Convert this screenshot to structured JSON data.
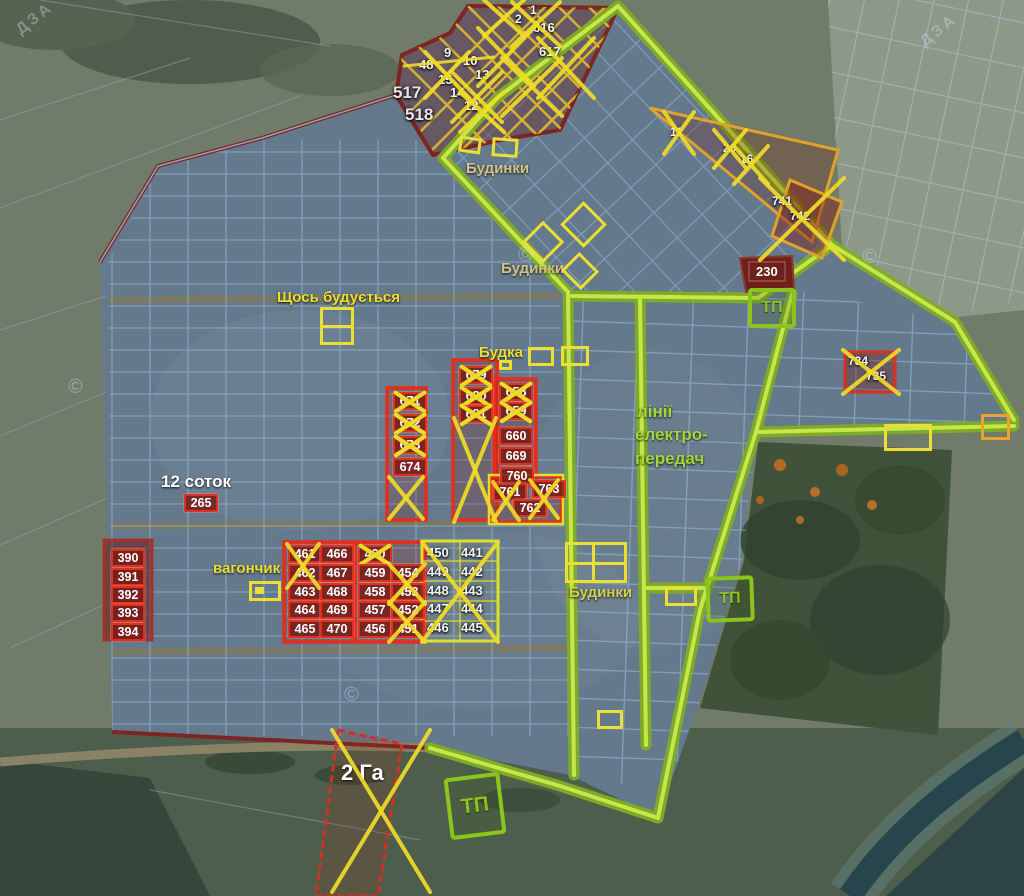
{
  "map": {
    "colors": {
      "lime_road": "#a8d838",
      "yellow_mark": "#f0dc28",
      "red_plot": "#e0301e",
      "maroon_boundary": "#7c2624",
      "blue_grid": "#9cc4e4",
      "tan_label": "#d2c387"
    },
    "labels": [
      {
        "t": "Будинки",
        "x": 466,
        "y": 160,
        "c": "tan"
      },
      {
        "t": "Будинки",
        "x": 501,
        "y": 260,
        "c": "tan"
      },
      {
        "t": "Щось будується",
        "x": 277,
        "y": 289,
        "c": "yellow"
      },
      {
        "t": "Будка",
        "x": 479,
        "y": 344,
        "c": "yellow"
      },
      {
        "t": "лінії",
        "x": 637,
        "y": 402,
        "c": "lime",
        "s": 17
      },
      {
        "t": "електро-",
        "x": 635,
        "y": 425,
        "c": "lime",
        "s": 17
      },
      {
        "t": "передач",
        "x": 635,
        "y": 449,
        "c": "lime",
        "s": 17
      },
      {
        "t": "12 соток",
        "x": 161,
        "y": 472,
        "c": "white",
        "s": 17
      },
      {
        "t": "вагончик",
        "x": 213,
        "y": 560,
        "c": "yellow"
      },
      {
        "t": "Будинки",
        "x": 569,
        "y": 584,
        "c": "khaki"
      },
      {
        "t": "2 Га",
        "x": 341,
        "y": 760,
        "c": "white",
        "s": 22
      }
    ],
    "plots": [
      {
        "n": "2",
        "x": 515,
        "y": 12,
        "s": "plain sm"
      },
      {
        "n": "1",
        "x": 530,
        "y": 3,
        "s": "plain sm"
      },
      {
        "n": "616",
        "x": 533,
        "y": 20,
        "s": "plain"
      },
      {
        "n": "617",
        "x": 539,
        "y": 44,
        "s": "plain"
      },
      {
        "n": "9",
        "x": 444,
        "y": 45,
        "s": "plain"
      },
      {
        "n": "48",
        "x": 419,
        "y": 57,
        "s": "plain"
      },
      {
        "n": "10",
        "x": 463,
        "y": 53,
        "s": "plain"
      },
      {
        "n": "15",
        "x": 438,
        "y": 72,
        "s": "plain"
      },
      {
        "n": "13",
        "x": 475,
        "y": 67,
        "s": "plain"
      },
      {
        "n": "14",
        "x": 450,
        "y": 85,
        "s": "plain"
      },
      {
        "n": "12",
        "x": 464,
        "y": 98,
        "s": "plain"
      },
      {
        "n": "517",
        "x": 393,
        "y": 83,
        "s": "plain big"
      },
      {
        "n": "518",
        "x": 405,
        "y": 105,
        "s": "plain big"
      },
      {
        "n": "11",
        "x": 670,
        "y": 125,
        "s": "plain sm"
      },
      {
        "n": "20",
        "x": 723,
        "y": 141,
        "s": "plain sm"
      },
      {
        "n": "16",
        "x": 740,
        "y": 152,
        "s": "plain sm"
      },
      {
        "n": "741",
        "x": 772,
        "y": 194,
        "s": "plain sm"
      },
      {
        "n": "742",
        "x": 790,
        "y": 209,
        "s": "plain sm"
      },
      {
        "n": "230",
        "x": 748,
        "y": 261,
        "s": "dark"
      },
      {
        "n": "734",
        "x": 848,
        "y": 354,
        "s": "plain sm"
      },
      {
        "n": "735",
        "x": 866,
        "y": 369,
        "s": "plain sm"
      },
      {
        "n": "671",
        "x": 393,
        "y": 392,
        "s": "chip",
        "c": 1
      },
      {
        "n": "672",
        "x": 393,
        "y": 414,
        "s": "chip",
        "c": 1
      },
      {
        "n": "673",
        "x": 393,
        "y": 436,
        "s": "chip",
        "c": 1
      },
      {
        "n": "674",
        "x": 393,
        "y": 458,
        "s": "chip"
      },
      {
        "n": "679",
        "x": 459,
        "y": 366,
        "s": "chip",
        "c": 1
      },
      {
        "n": "680",
        "x": 459,
        "y": 387,
        "s": "chip",
        "c": 1
      },
      {
        "n": "681",
        "x": 459,
        "y": 405,
        "s": "chip",
        "c": 1
      },
      {
        "n": "658",
        "x": 499,
        "y": 383,
        "s": "chip",
        "c": 1
      },
      {
        "n": "659",
        "x": 499,
        "y": 402,
        "s": "chip",
        "c": 1
      },
      {
        "n": "660",
        "x": 499,
        "y": 427,
        "s": "chip"
      },
      {
        "n": "669",
        "x": 499,
        "y": 447,
        "s": "chip"
      },
      {
        "n": "760",
        "x": 500,
        "y": 467,
        "s": "chip"
      },
      {
        "n": "761",
        "x": 493,
        "y": 483,
        "s": "chip"
      },
      {
        "n": "763",
        "x": 532,
        "y": 480,
        "s": "chip"
      },
      {
        "n": "762",
        "x": 513,
        "y": 499,
        "s": "chip"
      },
      {
        "n": "265",
        "x": 184,
        "y": 494,
        "s": "chip"
      },
      {
        "n": "390",
        "x": 111,
        "y": 549,
        "s": "chip"
      },
      {
        "n": "391",
        "x": 111,
        "y": 568,
        "s": "chip"
      },
      {
        "n": "392",
        "x": 111,
        "y": 586,
        "s": "chip"
      },
      {
        "n": "393",
        "x": 111,
        "y": 604,
        "s": "chip"
      },
      {
        "n": "394",
        "x": 111,
        "y": 623,
        "s": "chip"
      },
      {
        "n": "461",
        "x": 288,
        "y": 545,
        "s": "chip"
      },
      {
        "n": "462",
        "x": 288,
        "y": 564,
        "s": "chip"
      },
      {
        "n": "463",
        "x": 288,
        "y": 583,
        "s": "chip"
      },
      {
        "n": "464",
        "x": 288,
        "y": 601,
        "s": "chip"
      },
      {
        "n": "465",
        "x": 288,
        "y": 620,
        "s": "chip"
      },
      {
        "n": "466",
        "x": 320,
        "y": 545,
        "s": "chip"
      },
      {
        "n": "467",
        "x": 320,
        "y": 564,
        "s": "chip"
      },
      {
        "n": "468",
        "x": 320,
        "y": 583,
        "s": "chip"
      },
      {
        "n": "469",
        "x": 320,
        "y": 601,
        "s": "chip"
      },
      {
        "n": "470",
        "x": 320,
        "y": 620,
        "s": "chip"
      },
      {
        "n": "460",
        "x": 358,
        "y": 545,
        "s": "chip",
        "c": 1
      },
      {
        "n": "459",
        "x": 358,
        "y": 564,
        "s": "chip"
      },
      {
        "n": "458",
        "x": 358,
        "y": 583,
        "s": "chip"
      },
      {
        "n": "457",
        "x": 358,
        "y": 601,
        "s": "chip"
      },
      {
        "n": "456",
        "x": 358,
        "y": 620,
        "s": "chip"
      },
      {
        "n": "454",
        "x": 391,
        "y": 564,
        "s": "chip"
      },
      {
        "n": "453",
        "x": 391,
        "y": 583,
        "s": "chip"
      },
      {
        "n": "452",
        "x": 391,
        "y": 601,
        "s": "chip"
      },
      {
        "n": "451",
        "x": 391,
        "y": 620,
        "s": "chip"
      },
      {
        "n": "450",
        "x": 427,
        "y": 545,
        "s": "plain"
      },
      {
        "n": "449",
        "x": 427,
        "y": 564,
        "s": "plain"
      },
      {
        "n": "448",
        "x": 427,
        "y": 583,
        "s": "plain"
      },
      {
        "n": "447",
        "x": 427,
        "y": 601,
        "s": "plain"
      },
      {
        "n": "446",
        "x": 427,
        "y": 620,
        "s": "plain"
      },
      {
        "n": "441",
        "x": 461,
        "y": 545,
        "s": "plain"
      },
      {
        "n": "442",
        "x": 461,
        "y": 564,
        "s": "plain"
      },
      {
        "n": "443",
        "x": 461,
        "y": 583,
        "s": "plain"
      },
      {
        "n": "444",
        "x": 461,
        "y": 601,
        "s": "plain"
      },
      {
        "n": "445",
        "x": 461,
        "y": 620,
        "s": "plain"
      }
    ],
    "tp_boxes": [
      {
        "t": "ТП",
        "x": 748,
        "y": 288,
        "w": 40,
        "h": 32,
        "r": 0
      },
      {
        "t": "ТП",
        "x": 706,
        "y": 576,
        "w": 40,
        "h": 38,
        "r": -2
      },
      {
        "t": "ТП",
        "x": 447,
        "y": 775,
        "w": 48,
        "h": 54,
        "r": -7
      }
    ],
    "yellow_boxes": [
      {
        "x": 320,
        "y": 307,
        "w": 34,
        "h": 38,
        "mid": 1
      },
      {
        "x": 499,
        "y": 360,
        "w": 13,
        "h": 10
      },
      {
        "x": 528,
        "y": 347,
        "w": 26,
        "h": 19
      },
      {
        "x": 561,
        "y": 346,
        "w": 28,
        "h": 20
      },
      {
        "x": 459,
        "y": 137,
        "w": 22,
        "h": 16,
        "r": 8
      },
      {
        "x": 492,
        "y": 138,
        "w": 26,
        "h": 19,
        "r": 4
      },
      {
        "x": 528,
        "y": 227,
        "w": 30,
        "h": 30,
        "r": 45
      },
      {
        "x": 567,
        "y": 208,
        "w": 33,
        "h": 33,
        "r": 45
      },
      {
        "x": 566,
        "y": 258,
        "w": 28,
        "h": 26,
        "r": 45
      },
      {
        "x": 884,
        "y": 424,
        "w": 48,
        "h": 27
      },
      {
        "x": 981,
        "y": 414,
        "w": 29,
        "h": 26,
        "c": "#eda22c"
      },
      {
        "x": 665,
        "y": 586,
        "w": 32,
        "h": 20
      },
      {
        "x": 597,
        "y": 710,
        "w": 26,
        "h": 19
      },
      {
        "x": 565,
        "y": 542,
        "w": 62,
        "h": 41,
        "grid": 1
      },
      {
        "x": 249,
        "y": 581,
        "w": 32,
        "h": 20,
        "dot": 1
      }
    ],
    "xmarks": [
      {
        "x": 425,
        "y": 52,
        "w": 44,
        "h": 46
      },
      {
        "x": 452,
        "y": 72,
        "w": 50,
        "h": 50
      },
      {
        "x": 478,
        "y": 28,
        "w": 56,
        "h": 58
      },
      {
        "x": 502,
        "y": 58,
        "w": 60,
        "h": 58
      },
      {
        "x": 512,
        "y": 2,
        "w": 48,
        "h": 44
      },
      {
        "x": 538,
        "y": 38,
        "w": 56,
        "h": 60
      },
      {
        "x": 460,
        "y": 92,
        "w": 44,
        "h": 40
      },
      {
        "x": 484,
        "y": 0,
        "w": 40,
        "h": 36
      },
      {
        "x": 664,
        "y": 112,
        "w": 30,
        "h": 42
      },
      {
        "x": 714,
        "y": 130,
        "w": 32,
        "h": 38
      },
      {
        "x": 734,
        "y": 146,
        "w": 34,
        "h": 38
      },
      {
        "x": 760,
        "y": 178,
        "w": 84,
        "h": 82
      },
      {
        "x": 843,
        "y": 350,
        "w": 56,
        "h": 44
      },
      {
        "x": 389,
        "y": 477,
        "w": 34,
        "h": 42
      },
      {
        "x": 454,
        "y": 418,
        "w": 42,
        "h": 104
      },
      {
        "x": 493,
        "y": 482,
        "w": 26,
        "h": 38
      },
      {
        "x": 530,
        "y": 480,
        "w": 28,
        "h": 38
      },
      {
        "x": 287,
        "y": 544,
        "w": 32,
        "h": 44
      },
      {
        "x": 389,
        "y": 564,
        "w": 36,
        "h": 40
      },
      {
        "x": 389,
        "y": 602,
        "w": 36,
        "h": 40
      },
      {
        "x": 422,
        "y": 542,
        "w": 76,
        "h": 100
      },
      {
        "x": 332,
        "y": 730,
        "w": 98,
        "h": 162
      }
    ],
    "strikes": [
      {
        "x1": 404,
        "y1": 66,
        "x2": 494,
        "y2": 57
      }
    ],
    "watermarks": [
      {
        "t": "©",
        "x": 68,
        "y": 376
      },
      {
        "t": "©",
        "x": 344,
        "y": 684
      },
      {
        "t": "©",
        "x": 518,
        "y": 244
      },
      {
        "t": "©",
        "x": 862,
        "y": 246
      },
      {
        "t": "ДЗА",
        "x": 14,
        "y": 10,
        "r": -38
      },
      {
        "t": "ДЗА",
        "x": 918,
        "y": 22,
        "r": -38
      }
    ]
  }
}
